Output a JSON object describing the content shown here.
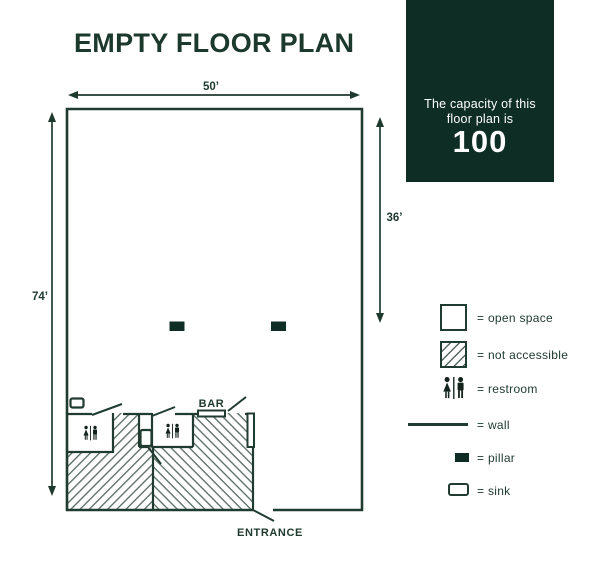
{
  "title": "EMPTY FLOOR PLAN",
  "capacity_card": {
    "line1": "The capacity of this",
    "line2": "floor plan is",
    "value": "100"
  },
  "floor_plan": {
    "width_label": "50’",
    "height_label": "74’",
    "right_section_label": "36’",
    "bar_label": "BAR",
    "entrance_label": "ENTRANCE",
    "pillar_count": 2,
    "restroom_count": 2,
    "sink_count": 2
  },
  "legend": {
    "items": [
      {
        "icon": "open-space-swatch",
        "label": "= open space"
      },
      {
        "icon": "not-accessible-swatch",
        "label": "= not accessible"
      },
      {
        "icon": "restroom-icon",
        "label": "= restroom"
      },
      {
        "icon": "wall-line",
        "label": "= wall"
      },
      {
        "icon": "pillar-swatch",
        "label": "= pillar"
      },
      {
        "icon": "sink-swatch",
        "label": "= sink"
      }
    ]
  },
  "colors": {
    "wall": "#203b30",
    "title_text": "#1c392d",
    "capacity_bg": "#0e2d25",
    "pillar": "#0e2d25",
    "hatch_line": "#566861",
    "figure": "#14231c"
  }
}
